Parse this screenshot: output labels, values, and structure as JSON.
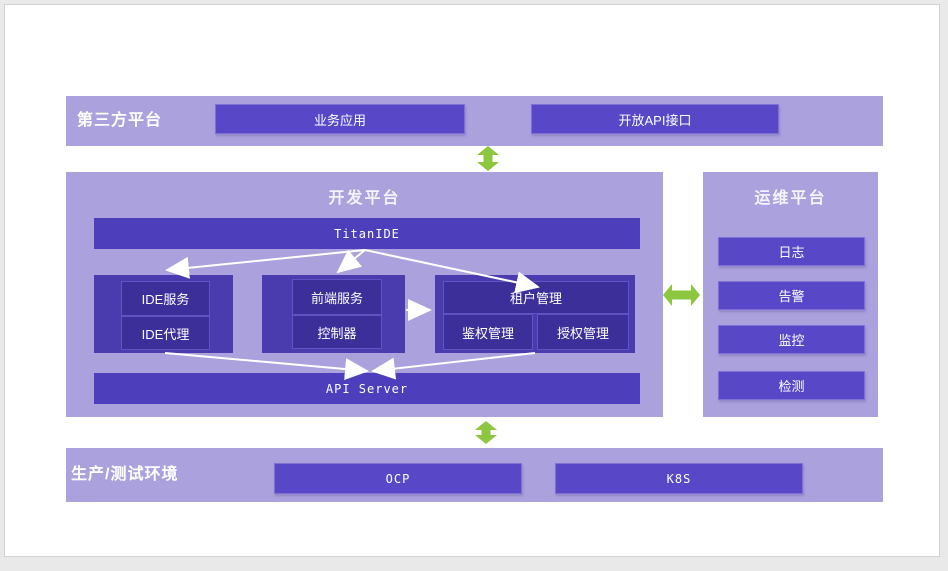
{
  "colors": {
    "band_bg": "#aba1dc",
    "button_purple": "#5848c8",
    "bar_purple": "#4d3fbc",
    "group_purple": "#4a3cae",
    "inner_purple": "#3c2f99",
    "arrow_green": "#8dc63f",
    "arrow_white": "#ffffff",
    "text": "#ffffff"
  },
  "third_party": {
    "title": "第三方平台",
    "boxes": [
      {
        "label": "业务应用"
      },
      {
        "label": "开放API接口"
      }
    ]
  },
  "dev_platform": {
    "title": "开发平台",
    "top_bar": "TitanIDE",
    "bottom_bar": "API Server",
    "groups": [
      {
        "items": [
          {
            "label": "IDE服务"
          },
          {
            "label": "IDE代理"
          }
        ]
      },
      {
        "items": [
          {
            "label": "前端服务"
          },
          {
            "label": "控制器"
          }
        ]
      },
      {
        "header": "租户管理",
        "items": [
          {
            "label": "鉴权管理"
          },
          {
            "label": "授权管理"
          }
        ]
      }
    ]
  },
  "ops_platform": {
    "title": "运维平台",
    "items": [
      {
        "label": "日志"
      },
      {
        "label": "告警"
      },
      {
        "label": "监控"
      },
      {
        "label": "检测"
      }
    ]
  },
  "production": {
    "title": "生产/测试环境",
    "boxes": [
      {
        "label": "OCP"
      },
      {
        "label": "K8S"
      }
    ]
  }
}
